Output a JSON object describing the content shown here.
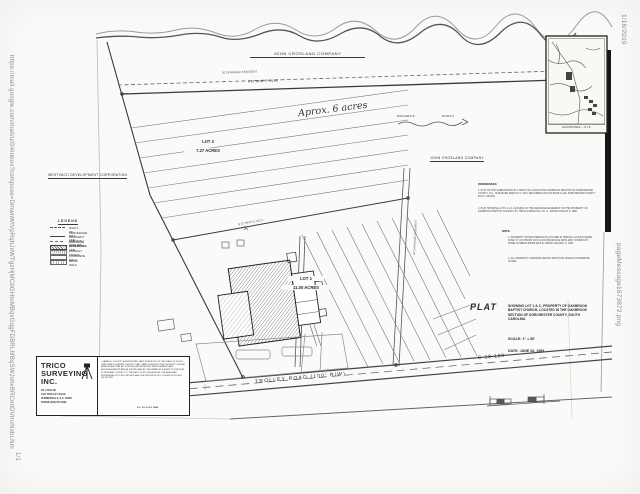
{
  "print_header": {
    "url": "https://mail.google.com/mail/u/0/#inbox?compose=DmwnWtVpRqhJnWTgzHjMCbGHtoMBqvGqgFDBRLhfBqSWJshvBRCmtDVmxNxbLNm",
    "date": "1/16/2019",
    "file_name": "pageMessage1673872.png",
    "page_indicator": "1/1"
  },
  "plat": {
    "neighbors": {
      "top": "JOHN CROSLAND COMPANY",
      "right": "JOHN CROSLAND COMPANY",
      "left": "WESTVACO DEVELOPMENT CORPORATION"
    },
    "annotations": {
      "handwritten_area": "Aprox. 6 acres",
      "easement_top": "20' DRAINAGE EASEMENT",
      "easement_vertical": "20' DRAINAGE EASEMENT",
      "bearing_top": "N 87°06'33\" E   791.80'",
      "bearing_division": "N 87°08'30\" E   462.1'",
      "magnetic_left": "MAGNETIC",
      "magnetic_right": "NORTH"
    },
    "lots": [
      {
        "name": "LOT 2",
        "area": "7.27 ACRES"
      },
      {
        "name": "LOT 1",
        "area": "11.00 ACRES"
      }
    ],
    "road": {
      "name": "TROLLEY  ROAD   (100' R/W)",
      "route": "S-18-199"
    },
    "legend": {
      "title": "LEGEND",
      "items": [
        {
          "label": "RIGHT-OF-WAY  LINE"
        },
        {
          "label": "CENTERLINE"
        },
        {
          "label": "PROPERTY LINE WITH IRON PIN"
        },
        {
          "label": "DRAINAGE EASEMENT LINE"
        },
        {
          "label": "STRUCTURE"
        },
        {
          "label": "ASPHALT  PAVING"
        },
        {
          "label": "CONCRETE  WALK"
        },
        {
          "label": "BRICK  WALK"
        }
      ]
    },
    "references": {
      "title": "REFERENCES:",
      "items": [
        "1.  PLAT OF THE SUBDIVISION OF A TRACT OF LAND IN THE OAKBROOK SECTION OF DORCHESTER COUNTY, S.C., SURVEYED MARCH 12, 1974, RECORDED IN PLAT BOOK E-118, DORCHESTER COUNTY R.M.C. OFFICE.",
        "2.  PLAT SHOWING LOTS 1 & 2, CLOSING OF THE DRAINAGE EASEMENT ON THE PROPERTY OF OAKBROOK BAPTIST CHURCH, BY TRICO SURVEYING, R.L.S., DATED AUGUST 8, 1988."
      ]
    },
    "notes": {
      "title": "NOTE:",
      "items": [
        "1.  PROPERTY SHOWN HEREON IS LOCATED IN SPECIAL FLOOD HAZARD ZONE \"C\" AS SHOWN ON FLOOD INSURANCE RATE MAP, COMMUNITY PANEL NUMBER 450068 0100 B, DATED JANUARY 6, 1982.",
        "2.  ALL PROPERTY CORNERS ARE 5/8\" IRON PINS UNLESS OTHERWISE NOTED."
      ]
    },
    "title_block": {
      "label": "PLAT",
      "description": "SHOWING LOT 1 & 2., PROPERTY OF OAKBROOK BAPTIST CHURCH, LOCATED IN THE OAKBROOK SECTION OF DORCHESTER COUNTY, SOUTH CAROLINA",
      "scale": "SCALE:  1\" = 50'",
      "date": "DATE:  JUNE 26, 1989"
    },
    "location_map": {
      "label": "LOCATION MAP — N.T.S."
    },
    "firm": {
      "name_line1": "TRICO",
      "name_line2": "SURVEYING",
      "name_line3": "INC.",
      "address": [
        "RT. 2  BOX 99",
        "OLD TROLLEY ROAD",
        "SUMMERVILLE, S.C. 29483",
        "PHONE (803) 873-2696"
      ],
      "certification": "I, JAMES E. COLLETT, A REGISTERED LAND SURVEYOR OF THE STATE OF SOUTH CAROLINA, DO HEREBY CERTIFY THAT I HAVE SURVEYED THE PROPERTY SHOWN HEREON AND THAT ALL EXISTING AND ADJACENT IMPROVEMENTS AND ENCROACHMENTS ARE AS SHOWN, AND ALL INFORMATION SHOWN ON THIS PLAT IS TRUE AND CORRECT TO THE BEST OF MY KNOWLEDGE. THE AREA WAS DETERMINED BY D.M.D. METHOD AND THE PRECISION OF CLOSURE IS 1/10,000 OR BETTER.",
      "license": "S.C. R.L.S. NO. 3845"
    }
  }
}
